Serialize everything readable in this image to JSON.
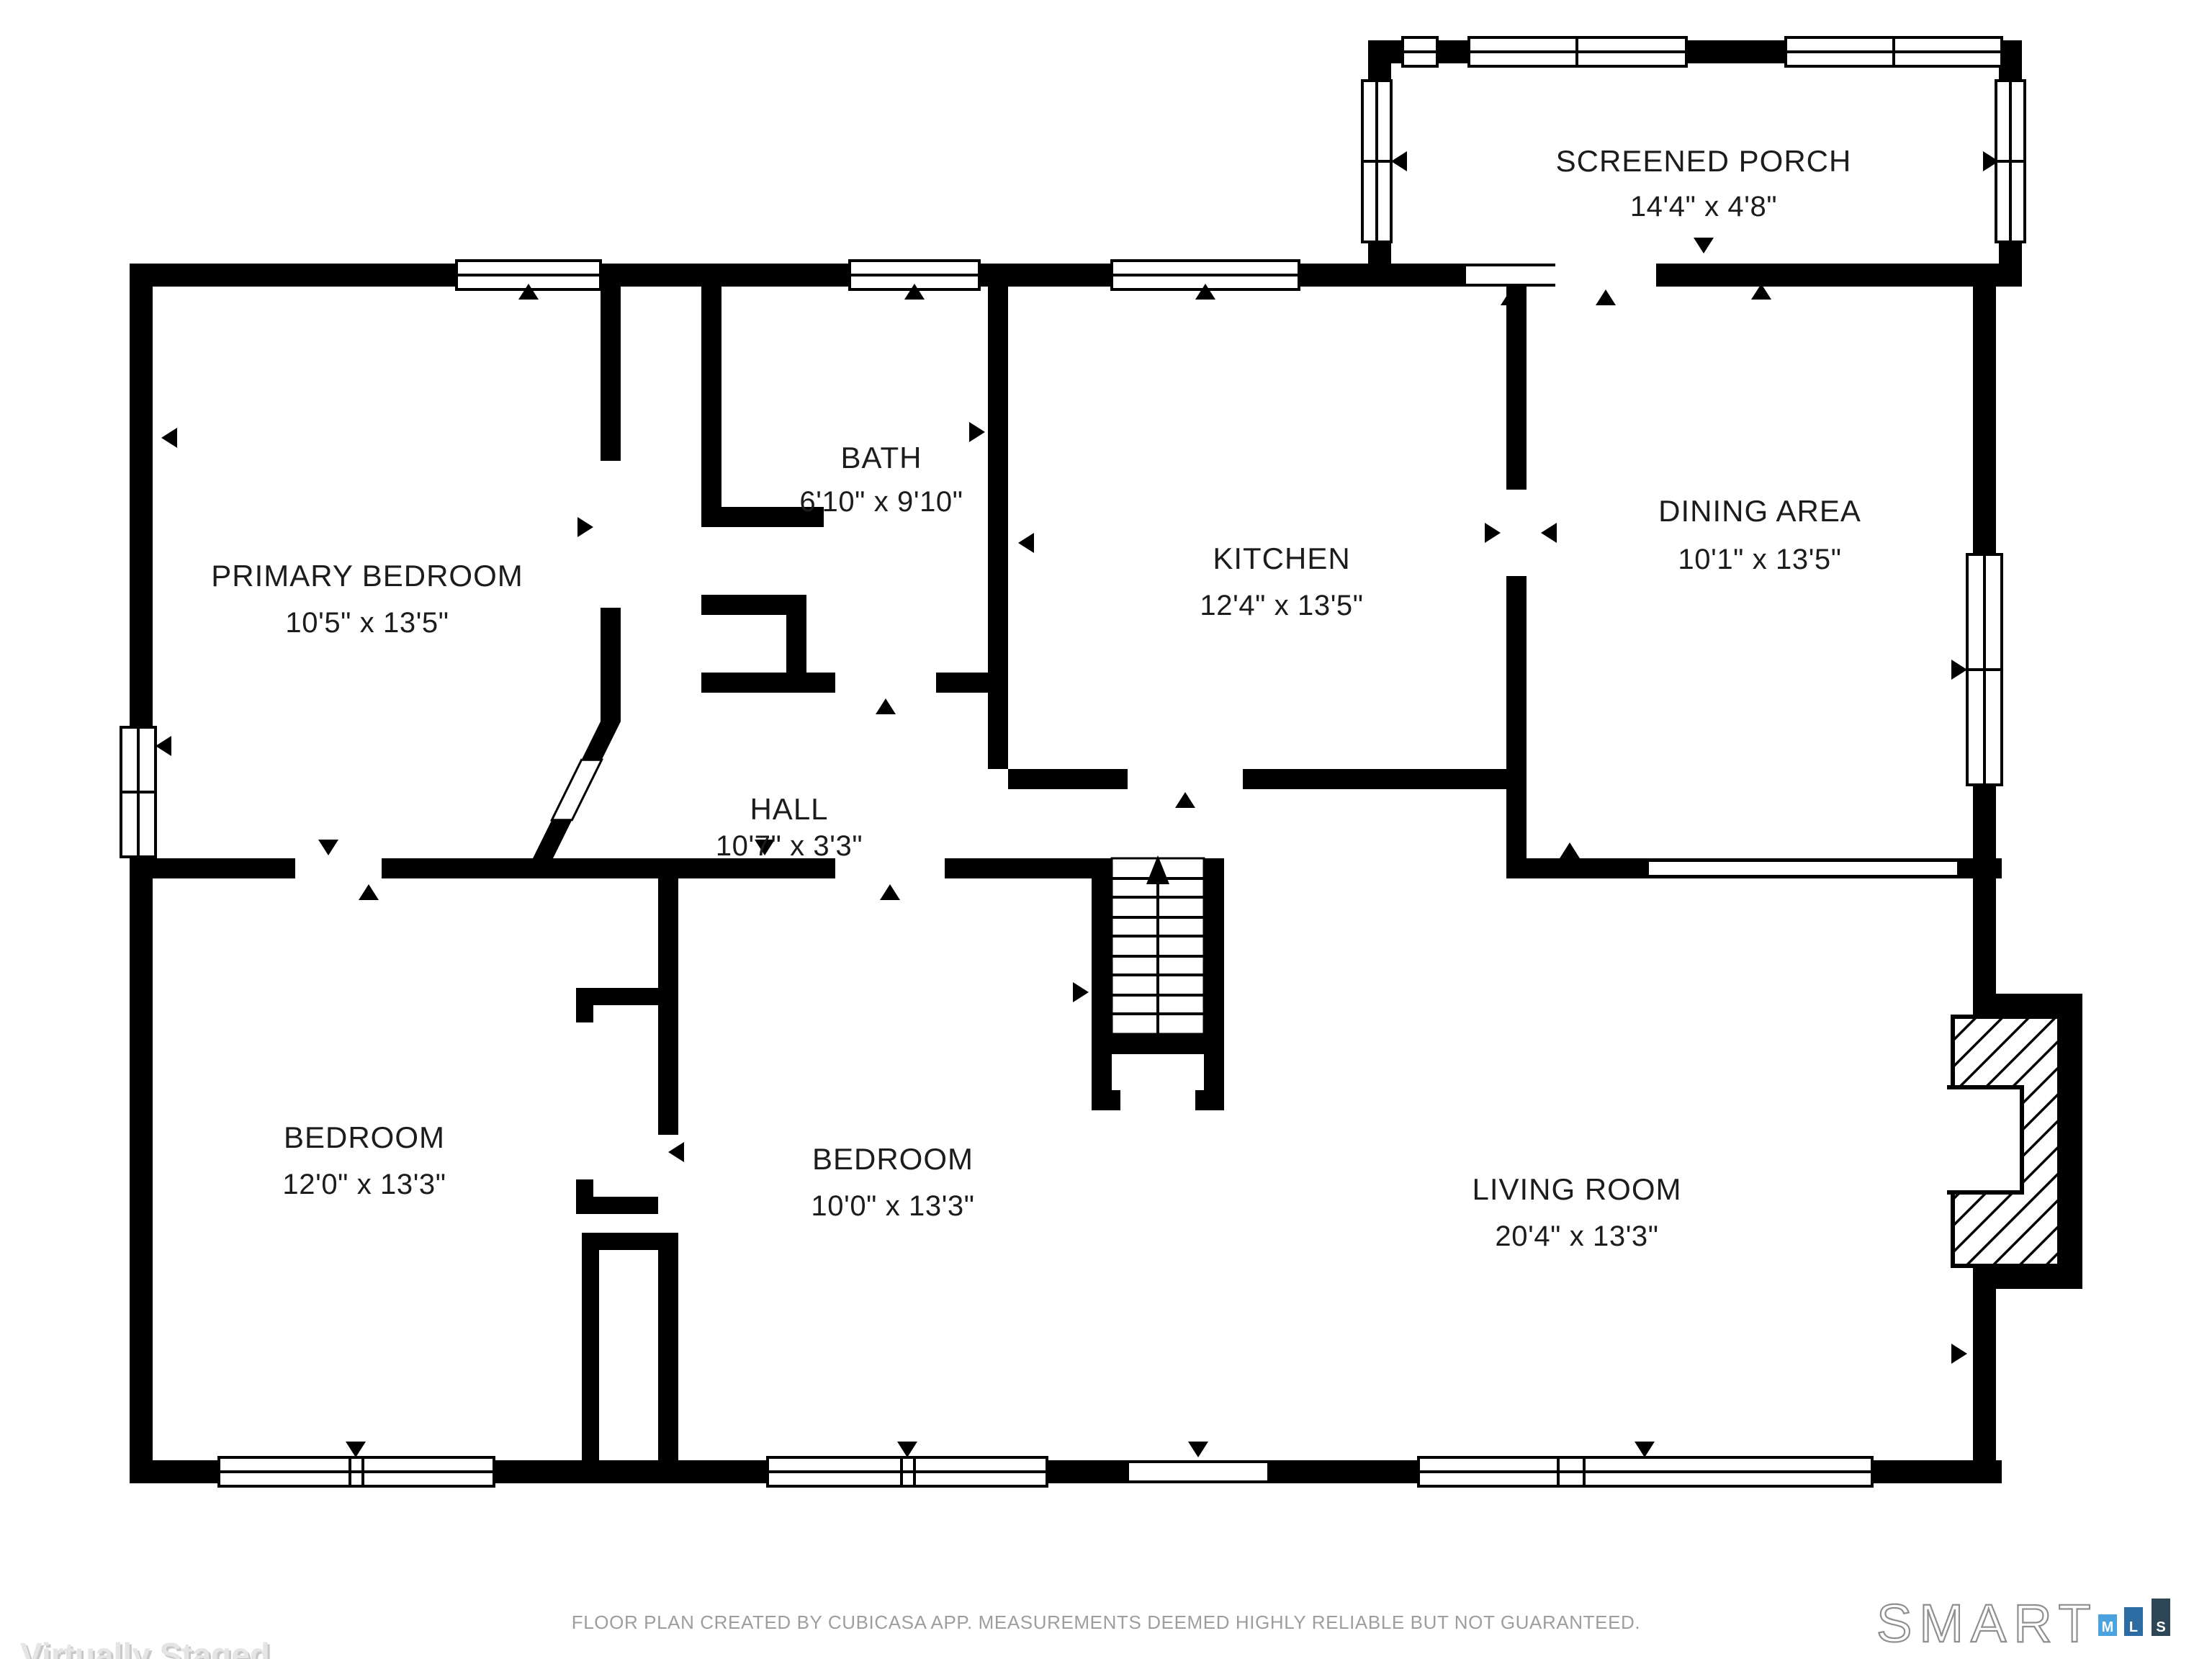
{
  "plan": {
    "wall_color": "#000000",
    "label_color": "#1c1c1c",
    "rooms": [
      {
        "id": "screened-porch",
        "name": "SCREENED PORCH",
        "dims": "14'4\" x 4'8\""
      },
      {
        "id": "primary-bedroom",
        "name": "PRIMARY BEDROOM",
        "dims": "10'5\" x 13'5\""
      },
      {
        "id": "bath",
        "name": "BATH",
        "dims": "6'10\" x 9'10\""
      },
      {
        "id": "kitchen",
        "name": "KITCHEN",
        "dims": "12'4\" x 13'5\""
      },
      {
        "id": "dining-area",
        "name": "DINING AREA",
        "dims": "10'1\" x 13'5\""
      },
      {
        "id": "hall",
        "name": "HALL",
        "dims": "10'7\" x 3'3\""
      },
      {
        "id": "bedroom-left",
        "name": "BEDROOM",
        "dims": "12'0\" x 13'3\""
      },
      {
        "id": "bedroom-middle",
        "name": "BEDROOM",
        "dims": "10'0\" x 13'3\""
      },
      {
        "id": "living-room",
        "name": "LIVING ROOM",
        "dims": "20'4\" x 13'3\""
      }
    ],
    "stairs": {
      "direction": "up",
      "treads": 9
    }
  },
  "footer": {
    "watermark": "Virtually Staged",
    "disclaimer": "FLOOR PLAN CREATED BY CUBICASA APP. MEASUREMENTS DEEMED HIGHLY RELIABLE BUT NOT GUARANTEED.",
    "brand": {
      "word": "SMART",
      "letters": [
        "M",
        "L",
        "S"
      ],
      "bar_colors": {
        "m": "#4AA3DD",
        "l": "#2D6CA3",
        "s": "#2E4757"
      }
    }
  }
}
